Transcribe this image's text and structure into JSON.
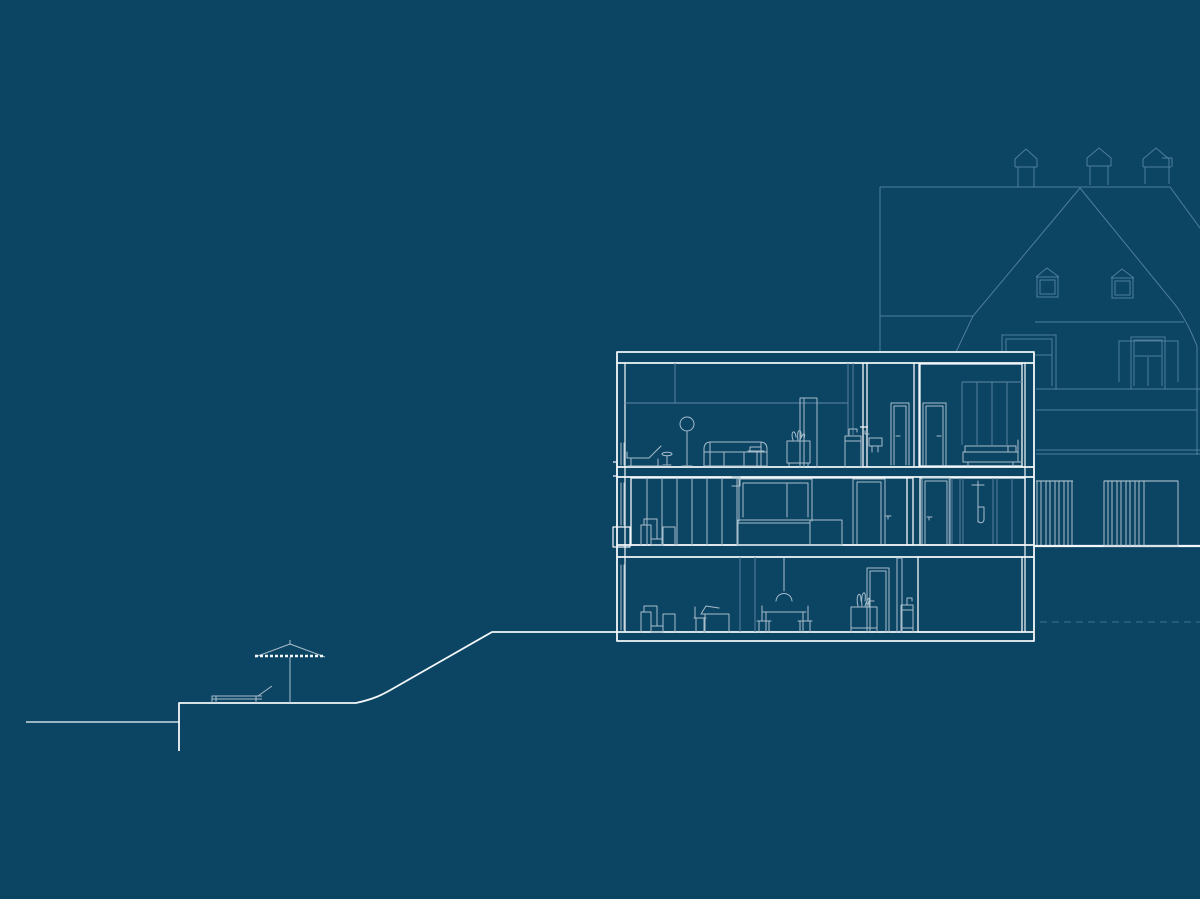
{
  "canvas": {
    "width": 1200,
    "height": 899
  },
  "colors": {
    "background": "#0C4464",
    "line_bright": "#F3F7F9",
    "line_medium": "#A7BECB",
    "line_faint": "#5F87A2",
    "line_house": "#4E7E9B",
    "line_fence": "#BFCFD8",
    "line_dashed": "#3E7190"
  },
  "scene": {
    "type": "architectural-section-and-site-elevation",
    "visible_text": "",
    "section_building": {
      "floors": 3,
      "upper_floor_items": [
        "lounge-chair",
        "side-table",
        "floor-lamp",
        "sofa",
        "tray-table",
        "plant-cabinet",
        "tall-wardrobe",
        "washbasin-unit",
        "wall-basin",
        "door",
        "door",
        "wardrobe",
        "bed"
      ],
      "middle_floor_items": [
        "wardrobe-slats",
        "armchair",
        "window",
        "bed-platform",
        "door",
        "door",
        "shower"
      ],
      "lower_floor_items": [
        "armchair",
        "desk-with-laptop",
        "pendant-lamp",
        "dining-table-with-chairs",
        "door",
        "vanity-with-plant",
        "washbasin",
        "empty-room"
      ]
    },
    "background_house": {
      "chimneys": 3,
      "dormer_windows": 2,
      "facade_windows": 2
    },
    "site": {
      "umbrella": 1,
      "sun_lounger": 1,
      "slat_fences": 2,
      "dashed_foundation_line": 1
    }
  }
}
